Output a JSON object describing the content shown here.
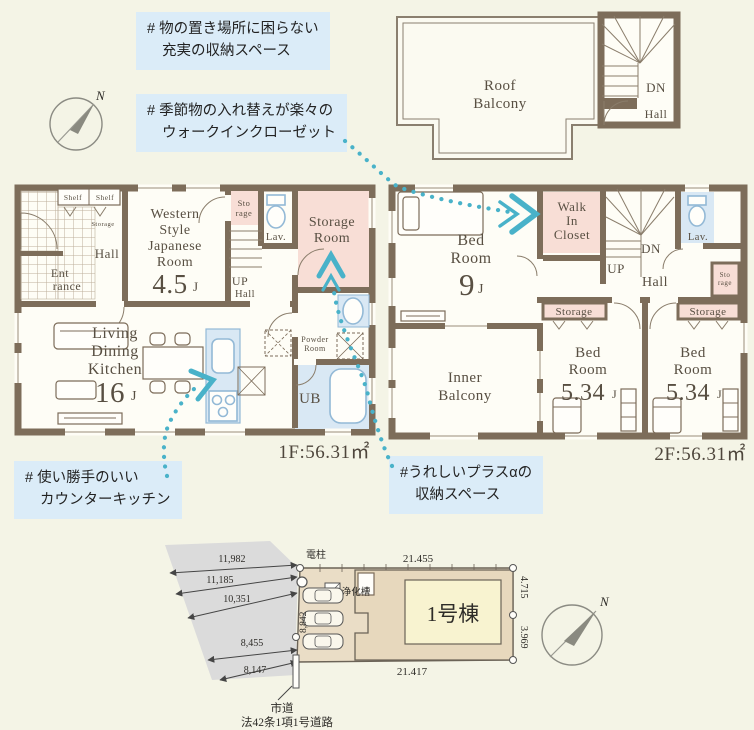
{
  "colors": {
    "background": "#f4f4e6",
    "wall": "#7d6d5a",
    "room_pink": "#f8ded6",
    "fixture_blue": "#d9e8f4",
    "callout_bg": "#dbecf8",
    "arrow_teal": "#49b2c9",
    "road_gray": "#dbdbdb",
    "plot_tan": "#eaddc6",
    "building_yellow": "#f8f3d0",
    "label_brown": "#584f42"
  },
  "callouts": {
    "c1_line1": "# 物の置き場所に困らない",
    "c1_line2": "充実の収納スペース",
    "c2_line1": "# 季節物の入れ替えが楽々の",
    "c2_line2": "ウォークインクローゼット",
    "c3_line1": "# 使い勝手のいい",
    "c3_line2": "カウンターキッチン",
    "c4_line1": "#うれしいプラスαの",
    "c4_line2": "収納スペース"
  },
  "compass": {
    "north": "N"
  },
  "roof": {
    "balcony_line1": "Roof",
    "balcony_line2": "Balcony",
    "dn": "DN",
    "hall": "Hall"
  },
  "f1": {
    "shelf_left": "Shelf",
    "shelf_right": "Shelf",
    "hall_storage": "Storage",
    "hall": "Hall",
    "entrance_line1": "Ent",
    "entrance_line2": "rance",
    "japanese_room_line1": "Western",
    "japanese_room_line2": "Style",
    "japanese_room_line3": "Japanese",
    "japanese_room_line4": "Room",
    "japanese_room_size": "4.5",
    "japanese_room_unit": "J",
    "storage_line1": "Sto",
    "storage_line2": "rage",
    "lav": "Lav.",
    "storage_room_line1": "Storage",
    "storage_room_line2": "Room",
    "stairs_up": "UP",
    "stairs_hall": "Hall",
    "ldk_line1": "Living",
    "ldk_line2": "Dining",
    "ldk_line3": "Kitchen",
    "ldk_size": "16",
    "ldk_unit": "J",
    "powder_line1": "Powder",
    "powder_line2": "Room",
    "bath": "UB",
    "area": "1F:56.31㎡"
  },
  "f2": {
    "bedroom9_line1": "Bed",
    "bedroom9_line2": "Room",
    "bedroom9_size": "9",
    "bedroom9_unit": "J",
    "wic_line1": "Walk",
    "wic_line2": "In",
    "wic_line3": "Closet",
    "stairs_dn": "DN",
    "stairs_up": "UP",
    "hall": "Hall",
    "lav": "Lav.",
    "storage_small_line1": "Sto",
    "storage_small_line2": "rage",
    "storage_left": "Storage",
    "storage_right": "Storage",
    "inner_balcony_line1": "Inner",
    "inner_balcony_line2": "Balcony",
    "bedroom_left_line1": "Bed",
    "bedroom_left_line2": "Room",
    "bedroom_left_size": "5.34",
    "bedroom_left_unit": "J",
    "bedroom_right_line1": "Bed",
    "bedroom_right_line2": "Room",
    "bedroom_right_size": "5.34",
    "bedroom_right_unit": "J",
    "area": "2F:56.31㎡"
  },
  "site": {
    "road_dims": [
      "11,982",
      "11,185",
      "10,351",
      "8,455",
      "8,147"
    ],
    "utility_pole": "電柱",
    "septic_tank": "浄化槽",
    "dim_top": "21.455",
    "dim_bottom": "21.417",
    "dim_right_upper": "4.715",
    "dim_right_lower": "3.969",
    "dim_parking": "8,842",
    "building_name": "1号棟",
    "road_label_line1": "市道",
    "road_label_line2": "法42条1項1号道路",
    "north": "N"
  }
}
